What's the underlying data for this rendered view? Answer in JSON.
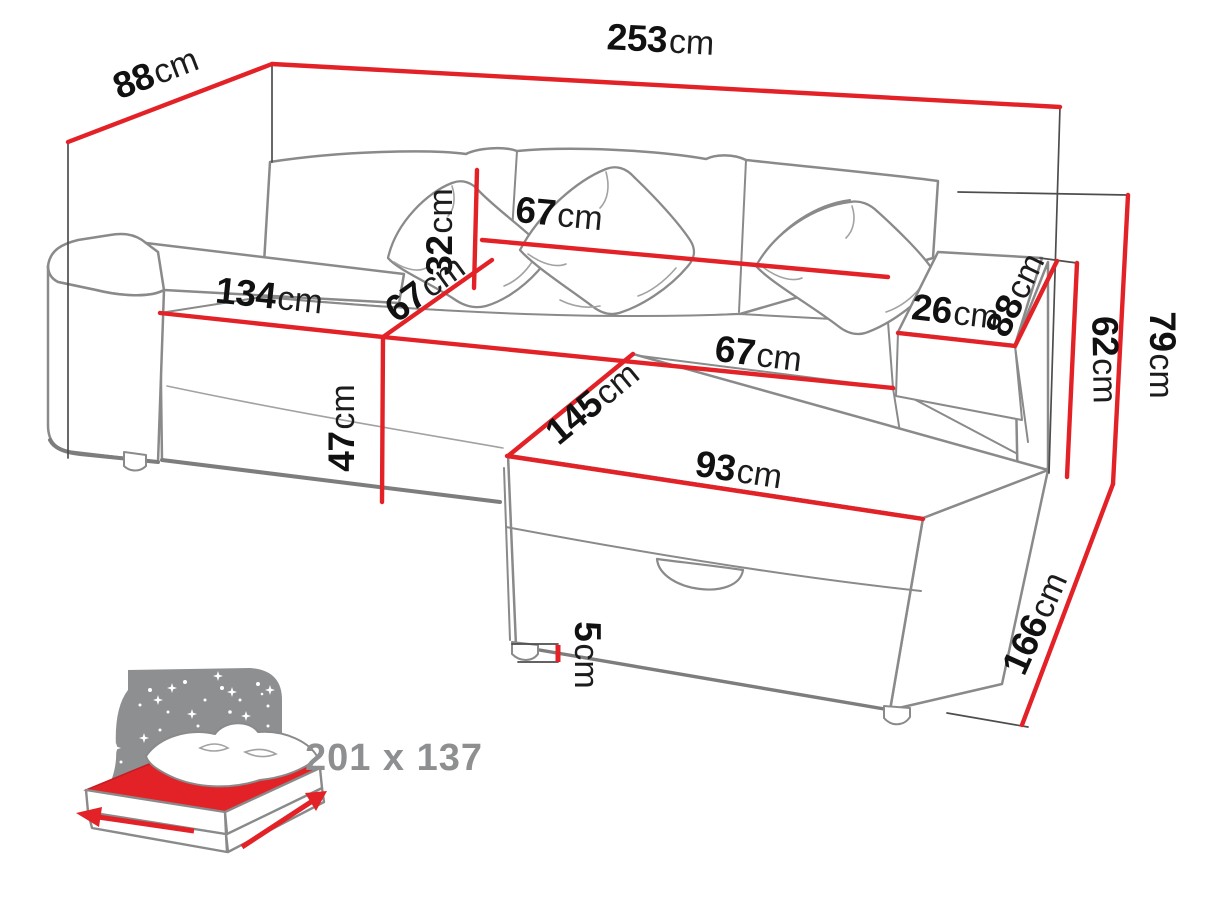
{
  "figure": {
    "type": "furniture-dimension-diagram",
    "subject": "corner sofa bed with storage",
    "accent_color": "#e32228",
    "outline_color": "#8a8a8a",
    "icon_gray": "#8d8f91"
  },
  "dimensions": {
    "total_width": {
      "value": "253",
      "unit": "cm"
    },
    "total_depth": {
      "value": "88",
      "unit": "cm"
    },
    "backrest_width": {
      "value": "67",
      "unit": "cm"
    },
    "backrest_height": {
      "value": "32",
      "unit": "cm"
    },
    "seat_width_left": {
      "value": "134",
      "unit": "cm"
    },
    "seat_depth_diagonal": {
      "value": "67",
      "unit": "cm"
    },
    "seat_width_right": {
      "value": "67",
      "unit": "cm"
    },
    "armrest_width": {
      "value": "26",
      "unit": "cm"
    },
    "armrest_depth": {
      "value": "88",
      "unit": "cm"
    },
    "armrest_height": {
      "value": "62",
      "unit": "cm"
    },
    "total_height": {
      "value": "79",
      "unit": "cm"
    },
    "seat_front_height": {
      "value": "47",
      "unit": "cm"
    },
    "chaise_length": {
      "value": "145",
      "unit": "cm"
    },
    "chaise_width": {
      "value": "93",
      "unit": "cm"
    },
    "side_depth": {
      "value": "166",
      "unit": "cm"
    },
    "leg_height": {
      "value": "5",
      "unit": "cm"
    }
  },
  "sleeping_area": {
    "label": "201 x 137"
  }
}
